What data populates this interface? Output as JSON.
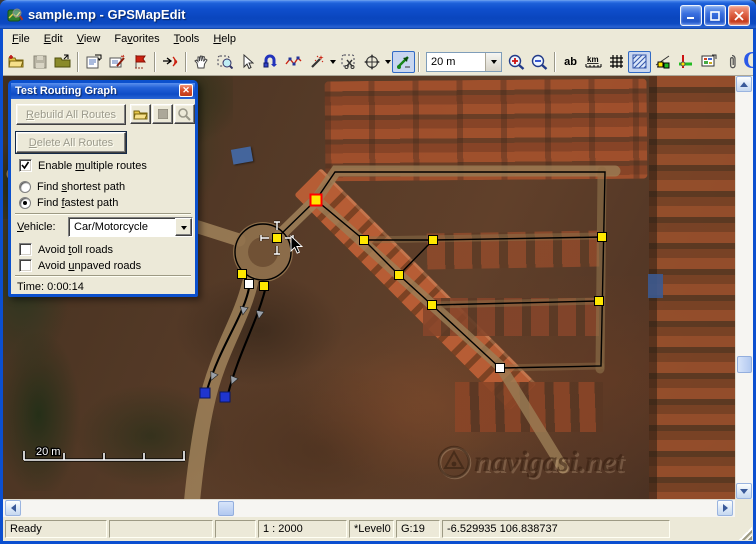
{
  "window": {
    "title": "sample.mp - GPSMapEdit",
    "controls": {
      "minimize": "minimize",
      "maximize": "maximize",
      "close": "close"
    }
  },
  "menu": {
    "items": [
      {
        "pre": "",
        "key": "F",
        "post": "ile"
      },
      {
        "pre": "",
        "key": "E",
        "post": "dit"
      },
      {
        "pre": "",
        "key": "V",
        "post": "iew"
      },
      {
        "pre": "Fa",
        "key": "v",
        "post": "orites"
      },
      {
        "pre": "",
        "key": "T",
        "post": "ools"
      },
      {
        "pre": "",
        "key": "H",
        "post": "elp"
      }
    ]
  },
  "toolbar": {
    "zoom_combo_value": "20 m",
    "ab_label": "ab",
    "km_label": "km",
    "icons": [
      "open-map-icon",
      "save-icon",
      "open-folder-icon",
      "map-properties-icon",
      "edit-objects-icon",
      "flag-icon",
      "routing-waves-icon",
      "pan-hand-icon",
      "zoom-select-icon",
      "select-arrow-icon",
      "uturn-icon",
      "polyline-icon",
      "magic-wand-icon",
      "cut-selection-icon",
      "move-objects-icon",
      "trim-route-icon",
      "zoom-in-icon",
      "zoom-out-icon",
      "labels-ab-icon",
      "ruler-km-icon",
      "grid-icon",
      "hatch-fill-icon",
      "route-nodes-icon",
      "junctions-icon",
      "raster-icon",
      "attach-icon",
      "logo-g"
    ]
  },
  "dialog": {
    "title": "Test Routing Graph",
    "rebuild": {
      "pre": "",
      "key": "R",
      "post": "ebuild All Routes"
    },
    "delete": {
      "pre": "",
      "key": "D",
      "post": "elete All Routes"
    },
    "enable_multiple": {
      "pre": "Enable ",
      "key": "m",
      "post": "ultiple routes"
    },
    "shortest": {
      "pre": "Find ",
      "key": "s",
      "post": "hortest path"
    },
    "fastest": {
      "pre": "Find ",
      "key": "f",
      "post": "astest path"
    },
    "vehicle_label": {
      "pre": "",
      "key": "V",
      "post": "ehicle:"
    },
    "vehicle_value": "Car/Motorcycle",
    "avoid_toll": {
      "pre": "Avoid ",
      "key": "t",
      "post": "oll roads"
    },
    "avoid_unpaved": {
      "pre": "Avoid ",
      "key": "u",
      "post": "npaved roads"
    },
    "time": "Time: 0:00:14"
  },
  "map_overlay": {
    "scale_label": "20 m",
    "watermark": "navigasi.net",
    "colors": {
      "node_yellow": "#ffe800",
      "node_selected_border": "#ff0000",
      "node_blue": "#1f35cf",
      "edge": "#000000"
    },
    "nodes": [
      {
        "x": 313,
        "y": 124,
        "t": "selected"
      },
      {
        "x": 361,
        "y": 164,
        "t": "yellow"
      },
      {
        "x": 430,
        "y": 164,
        "t": "yellow"
      },
      {
        "x": 599,
        "y": 161,
        "t": "yellow"
      },
      {
        "x": 396,
        "y": 199,
        "t": "yellow"
      },
      {
        "x": 429,
        "y": 229,
        "t": "yellow"
      },
      {
        "x": 596,
        "y": 225,
        "t": "yellow"
      },
      {
        "x": 497,
        "y": 292,
        "t": "white"
      },
      {
        "x": 274,
        "y": 162,
        "t": "yellow"
      },
      {
        "x": 239,
        "y": 198,
        "t": "yellow"
      },
      {
        "x": 261,
        "y": 210,
        "t": "yellow"
      },
      {
        "x": 246,
        "y": 208,
        "t": "white"
      },
      {
        "x": 202,
        "y": 317,
        "t": "blue"
      },
      {
        "x": 222,
        "y": 321,
        "t": "blue"
      }
    ],
    "edges": [
      "313,124 332,96 602,96 598,290 497,292",
      "313,124 361,164 396,199 429,229 497,292",
      "361,164 430,164 599,161",
      "396,199 430,164",
      "429,229 596,225",
      "313,124 274,162"
    ],
    "circle": {
      "cx": 260,
      "cy": 176,
      "r": 28
    },
    "routes": [
      {
        "d": "M246,212 C240,242 218,268 204,314"
      },
      {
        "d": "M262,214 C254,246 236,276 225,318"
      }
    ],
    "arrows": [
      {
        "x": 241,
        "y": 232,
        "a": 100
      },
      {
        "x": 257,
        "y": 236,
        "a": 100
      },
      {
        "x": 211,
        "y": 298,
        "a": 115
      },
      {
        "x": 231,
        "y": 302,
        "a": 112
      }
    ],
    "crosshair": {
      "x": 274,
      "y": 162
    },
    "cursor": {
      "x": 288,
      "y": 160
    }
  },
  "status": {
    "panes": [
      "Ready",
      "",
      "",
      "1 : 2000",
      "*Level0",
      "G:19",
      "-6.529935 106.838737"
    ]
  }
}
